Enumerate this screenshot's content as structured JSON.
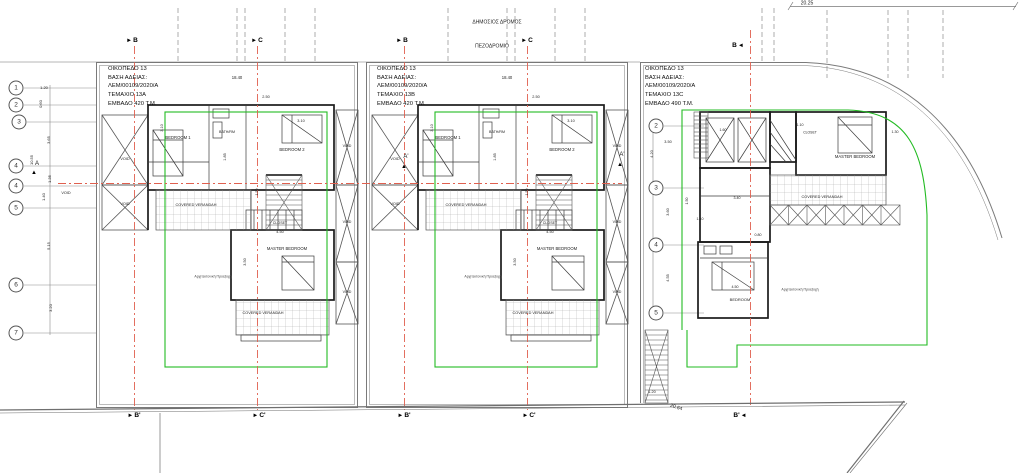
{
  "drawing": {
    "type": "architectural site / floor plan",
    "road_label": "ΔΗΜΟΣΙΟΣ ΔΡΟΜΟΣ",
    "sidewalk_label": "ΠΕΖΟΔΡΟΜΙΟ"
  },
  "colors": {
    "axis_red": "#e0604f",
    "setback_green": "#22bb22",
    "wall": "#1b1b1b",
    "line_gray": "#777777"
  },
  "units": [
    {
      "plot": "ΟΙΚΟΠΕΔΟ 13",
      "permit": "ΒΑΣΗ ΑΔΕΙΑΣ:",
      "permit_no": "ΛΕΜ/00109/2020/Α",
      "parcel": "ΤΕΜΑΧΙΟ 13Α",
      "area": "ΕΜΒΑΔΟ 420 Τ.Μ.",
      "x": 108,
      "y": 65
    },
    {
      "plot": "ΟΙΚΟΠΕΔΟ 13",
      "permit": "ΒΑΣΗ ΑΔΕΙΑΣ:",
      "permit_no": "ΛΕΜ/00109/2020/Α",
      "parcel": "ΤΕΜΑΧΙΟ 13Β",
      "area": "ΕΜΒΑΔΟ 420 Τ.Μ.",
      "x": 377,
      "y": 65
    },
    {
      "plot": "ΟΙΚΟΠΕΔΟ 13",
      "permit": "ΒΑΣΗ ΑΔΕΙΑΣ:",
      "permit_no": "ΛΕΜ/00109/2020/Α",
      "parcel": "ΤΕΜΑΧΙΟ 13C",
      "area": "ΕΜΒΑΔΟ 490 Τ.Μ.",
      "x": 645,
      "y": 65
    }
  ],
  "grid_bubbles": [
    {
      "label": "1",
      "x": 16,
      "y": 88
    },
    {
      "label": "2",
      "x": 16,
      "y": 105
    },
    {
      "label": "3",
      "x": 19,
      "y": 122
    },
    {
      "label": "4",
      "x": 16,
      "y": 166
    },
    {
      "label": "4",
      "x": 16,
      "y": 186
    },
    {
      "label": "5",
      "x": 16,
      "y": 208
    },
    {
      "label": "6",
      "x": 16,
      "y": 285
    },
    {
      "label": "7",
      "x": 16,
      "y": 333
    },
    {
      "label": "2",
      "x": 656,
      "y": 126
    },
    {
      "label": "3",
      "x": 656,
      "y": 188
    },
    {
      "label": "4",
      "x": 656,
      "y": 245
    },
    {
      "label": "5",
      "x": 656,
      "y": 313
    }
  ],
  "section_markers": [
    {
      "label": "B",
      "arrow": "►",
      "order": "arrow-first",
      "x": 132,
      "y": 41
    },
    {
      "label": "C",
      "arrow": "►",
      "order": "arrow-first",
      "x": 257,
      "y": 41
    },
    {
      "label": "B",
      "arrow": "►",
      "order": "arrow-first",
      "x": 402,
      "y": 41
    },
    {
      "label": "C",
      "arrow": "►",
      "order": "arrow-first",
      "x": 527,
      "y": 41
    },
    {
      "label": "B",
      "arrow": "◄",
      "order": "label-first",
      "x": 738,
      "y": 46
    },
    {
      "label": "B'",
      "arrow": "►",
      "order": "arrow-first",
      "x": 134,
      "y": 416
    },
    {
      "label": "C'",
      "arrow": "►",
      "order": "arrow-first",
      "x": 259,
      "y": 416
    },
    {
      "label": "B'",
      "arrow": "►",
      "order": "arrow-first",
      "x": 404,
      "y": 416
    },
    {
      "label": "C'",
      "arrow": "►",
      "order": "arrow-first",
      "x": 529,
      "y": 416
    },
    {
      "label": "B'",
      "arrow": "◄",
      "order": "label-first",
      "x": 740,
      "y": 416
    }
  ],
  "labels": [
    {
      "t": "ΔΗΜΟΣΙΟΣ ΔΡΟΜΟΣ",
      "x": 497,
      "y": 23,
      "s": 5,
      "n": "street-label"
    },
    {
      "t": "ΠΕΖΟΔΡΟΜΙΟ",
      "x": 492,
      "y": 47,
      "s": 5,
      "n": "sidewalk-label"
    },
    {
      "t": "20.25",
      "x": 807,
      "y": 4,
      "s": 5,
      "n": "dim-label"
    },
    {
      "t": "20.64",
      "x": 676,
      "y": 408,
      "s": 5,
      "r": 18,
      "n": "dim-label"
    },
    {
      "t": "1.20",
      "x": 44,
      "y": 88,
      "s": 4,
      "n": "dim-label"
    },
    {
      "t": "0.60",
      "x": 41,
      "y": 104,
      "s": 4,
      "r": -90,
      "n": "dim-label"
    },
    {
      "t": "3.65",
      "x": 49,
      "y": 140,
      "s": 4,
      "r": -90,
      "n": "dim-label"
    },
    {
      "t": "10.55",
      "x": 32,
      "y": 160,
      "s": 4,
      "r": -90,
      "n": "dim-label"
    },
    {
      "t": "1.35",
      "x": 50,
      "y": 179,
      "s": 4,
      "r": -90,
      "n": "dim-label"
    },
    {
      "t": "1.40",
      "x": 44,
      "y": 197,
      "s": 4,
      "r": -90,
      "n": "dim-label"
    },
    {
      "t": "5.15",
      "x": 49,
      "y": 246,
      "s": 4,
      "r": -90,
      "n": "dim-label"
    },
    {
      "t": "3.20",
      "x": 51,
      "y": 308,
      "s": 4,
      "r": -90,
      "n": "dim-label"
    },
    {
      "t": "VOID",
      "x": 66,
      "y": 194,
      "s": 3.8,
      "n": "void-label"
    },
    {
      "t": "A",
      "x": 37,
      "y": 164,
      "s": 6,
      "n": "section-letter"
    },
    {
      "t": "▲",
      "x": 34,
      "y": 173,
      "s": 6,
      "c": "#000",
      "n": "triangle-marker-icon"
    },
    {
      "t": "A'",
      "x": 406,
      "y": 157,
      "s": 6,
      "n": "section-letter"
    },
    {
      "t": "▲",
      "x": 404,
      "y": 167,
      "s": 6,
      "c": "#000",
      "n": "triangle-marker-icon"
    },
    {
      "t": "A'",
      "x": 622,
      "y": 155,
      "s": 6,
      "n": "section-letter"
    },
    {
      "t": "▲",
      "x": 620,
      "y": 165,
      "s": 6,
      "c": "#000",
      "n": "triangle-marker-icon"
    },
    {
      "t": "BEDROOM 1",
      "x": 178,
      "y": 138,
      "s": 4.2,
      "n": "room-label"
    },
    {
      "t": "BATH/RM",
      "x": 227,
      "y": 133,
      "s": 3.6,
      "n": "room-label"
    },
    {
      "t": "BEDROOM 2",
      "x": 292,
      "y": 150,
      "s": 4.2,
      "n": "room-label"
    },
    {
      "t": "CLOSET",
      "x": 280,
      "y": 224,
      "s": 3.6,
      "n": "room-label"
    },
    {
      "t": "MASTER BEDROOM",
      "x": 287,
      "y": 249,
      "s": 4.2,
      "n": "room-label"
    },
    {
      "t": "COVERED VERANDAH",
      "x": 196,
      "y": 206,
      "s": 3.8,
      "n": "room-label"
    },
    {
      "t": "COVERED VERANDAH",
      "x": 263,
      "y": 314,
      "s": 3.8,
      "n": "room-label"
    },
    {
      "t": "VOID",
      "x": 125,
      "y": 160,
      "s": 3.8,
      "n": "void-label"
    },
    {
      "t": "VOID",
      "x": 125,
      "y": 205,
      "s": 3.8,
      "n": "void-label"
    },
    {
      "t": "VOID",
      "x": 347,
      "y": 147,
      "s": 3.6,
      "n": "void-label"
    },
    {
      "t": "VOID",
      "x": 347,
      "y": 223,
      "s": 3.6,
      "n": "void-label"
    },
    {
      "t": "VOID",
      "x": 347,
      "y": 293,
      "s": 3.6,
      "n": "void-label"
    },
    {
      "t": "18.40",
      "x": 237,
      "y": 78,
      "s": 4.2,
      "n": "dim-label"
    },
    {
      "t": "2.50",
      "x": 266,
      "y": 98,
      "s": 3.8,
      "n": "dim-label"
    },
    {
      "t": "3.10",
      "x": 163,
      "y": 128,
      "s": 3.8,
      "r": -90,
      "n": "dim-label"
    },
    {
      "t": "3.10",
      "x": 301,
      "y": 122,
      "s": 3.8,
      "n": "dim-label"
    },
    {
      "t": "4.50",
      "x": 280,
      "y": 233,
      "s": 3.8,
      "n": "dim-label"
    },
    {
      "t": "3.50",
      "x": 246,
      "y": 262,
      "s": 3.8,
      "r": -90,
      "n": "dim-label"
    },
    {
      "t": "1.85",
      "x": 226,
      "y": 157,
      "s": 3.8,
      "r": -90,
      "n": "dim-label"
    },
    {
      "t": "1.50",
      "x": 258,
      "y": 192,
      "s": 3.6,
      "r": -90,
      "n": "dim-label"
    },
    {
      "t": "Αρχιτεκτονική Προεξοχή",
      "x": 213,
      "y": 277,
      "s": 3.5,
      "c": "#444",
      "n": "overhang-label"
    },
    {
      "t": "BEDROOM 1",
      "x": 448,
      "y": 138,
      "s": 4.2,
      "n": "room-label"
    },
    {
      "t": "BATH/RM",
      "x": 497,
      "y": 133,
      "s": 3.6,
      "n": "room-label"
    },
    {
      "t": "BEDROOM 2",
      "x": 562,
      "y": 150,
      "s": 4.2,
      "n": "room-label"
    },
    {
      "t": "CLOSET",
      "x": 550,
      "y": 224,
      "s": 3.6,
      "n": "room-label"
    },
    {
      "t": "MASTER BEDROOM",
      "x": 557,
      "y": 249,
      "s": 4.2,
      "n": "room-label"
    },
    {
      "t": "COVERED VERANDAH",
      "x": 466,
      "y": 206,
      "s": 3.8,
      "n": "room-label"
    },
    {
      "t": "COVERED VERANDAH",
      "x": 533,
      "y": 314,
      "s": 3.8,
      "n": "room-label"
    },
    {
      "t": "VOID",
      "x": 395,
      "y": 160,
      "s": 3.8,
      "n": "void-label"
    },
    {
      "t": "VOID",
      "x": 395,
      "y": 205,
      "s": 3.8,
      "n": "void-label"
    },
    {
      "t": "VOID",
      "x": 617,
      "y": 147,
      "s": 3.6,
      "n": "void-label"
    },
    {
      "t": "VOID",
      "x": 617,
      "y": 223,
      "s": 3.6,
      "n": "void-label"
    },
    {
      "t": "VOID",
      "x": 617,
      "y": 293,
      "s": 3.6,
      "n": "void-label"
    },
    {
      "t": "18.40",
      "x": 507,
      "y": 78,
      "s": 4.2,
      "n": "dim-label"
    },
    {
      "t": "2.50",
      "x": 536,
      "y": 98,
      "s": 3.8,
      "n": "dim-label"
    },
    {
      "t": "3.10",
      "x": 433,
      "y": 128,
      "s": 3.8,
      "r": -90,
      "n": "dim-label"
    },
    {
      "t": "3.10",
      "x": 571,
      "y": 122,
      "s": 3.8,
      "n": "dim-label"
    },
    {
      "t": "4.50",
      "x": 550,
      "y": 233,
      "s": 3.8,
      "n": "dim-label"
    },
    {
      "t": "3.50",
      "x": 516,
      "y": 262,
      "s": 3.8,
      "r": -90,
      "n": "dim-label"
    },
    {
      "t": "1.85",
      "x": 496,
      "y": 157,
      "s": 3.8,
      "r": -90,
      "n": "dim-label"
    },
    {
      "t": "1.50",
      "x": 528,
      "y": 192,
      "s": 3.6,
      "r": -90,
      "n": "dim-label"
    },
    {
      "t": "Αρχιτεκτονική Προεξοχή",
      "x": 483,
      "y": 277,
      "s": 3.5,
      "c": "#444",
      "n": "overhang-label"
    },
    {
      "t": "MASTER BEDROOM",
      "x": 855,
      "y": 157,
      "s": 4.2,
      "n": "room-label"
    },
    {
      "t": "CLOSET",
      "x": 810,
      "y": 133,
      "s": 3.4,
      "n": "room-label"
    },
    {
      "t": "BEDROOM",
      "x": 740,
      "y": 300,
      "s": 4,
      "n": "room-label"
    },
    {
      "t": "COVERED VERANDAH",
      "x": 822,
      "y": 198,
      "s": 3.8,
      "n": "room-label"
    },
    {
      "t": "Αρχιτεκτονική Προεξοχή",
      "x": 800,
      "y": 290,
      "s": 3.5,
      "c": "#444",
      "n": "overhang-label"
    },
    {
      "t": "3.50",
      "x": 668,
      "y": 143,
      "s": 3.8,
      "n": "dim-label"
    },
    {
      "t": "4.20",
      "x": 653,
      "y": 154,
      "s": 3.8,
      "r": -90,
      "n": "dim-label"
    },
    {
      "t": "3.60",
      "x": 669,
      "y": 212,
      "s": 3.8,
      "r": -90,
      "n": "dim-label"
    },
    {
      "t": "4.55",
      "x": 669,
      "y": 278,
      "s": 3.8,
      "r": -90,
      "n": "dim-label"
    },
    {
      "t": "1.50",
      "x": 688,
      "y": 201,
      "s": 3.6,
      "r": -90,
      "n": "dim-label"
    },
    {
      "t": "1.10",
      "x": 700,
      "y": 220,
      "s": 3.6,
      "n": "dim-label"
    },
    {
      "t": "1.60",
      "x": 723,
      "y": 131,
      "s": 3.6,
      "n": "dim-label"
    },
    {
      "t": "1.10",
      "x": 800,
      "y": 126,
      "s": 3.6,
      "n": "dim-label"
    },
    {
      "t": "3.40",
      "x": 737,
      "y": 199,
      "s": 3.6,
      "n": "dim-label"
    },
    {
      "t": "4.50",
      "x": 735,
      "y": 288,
      "s": 3.6,
      "n": "dim-label"
    },
    {
      "t": "0.80",
      "x": 758,
      "y": 236,
      "s": 3.6,
      "n": "dim-label"
    },
    {
      "t": "1.30",
      "x": 895,
      "y": 133,
      "s": 3.6,
      "n": "dim-label"
    },
    {
      "t": "1.20",
      "x": 652,
      "y": 393,
      "s": 3.8,
      "n": "dim-label"
    }
  ]
}
